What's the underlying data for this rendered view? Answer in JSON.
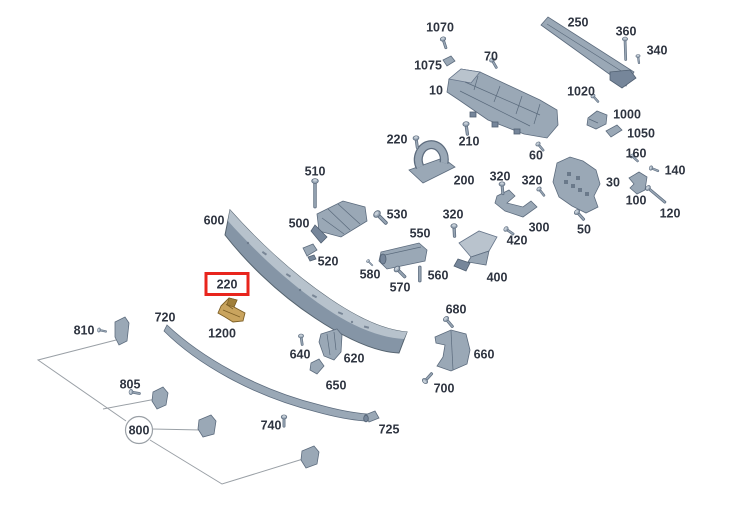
{
  "app": {
    "background": "#ffffff"
  },
  "diagram": {
    "kind": "exploded-parts-diagram",
    "selected_callout": "220",
    "colors": {
      "highlight_box": "#e8251d",
      "highlighted_part": "#c9a45e",
      "part_body": "#9aa8b6",
      "leader_line": "#9aa0a6",
      "label_text": "#2e3440"
    },
    "callouts": [
      {
        "text": "1070",
        "x": 440,
        "y": 27
      },
      {
        "text": "250",
        "x": 578,
        "y": 22
      },
      {
        "text": "360",
        "x": 626,
        "y": 31
      },
      {
        "text": "340",
        "x": 657,
        "y": 50
      },
      {
        "text": "70",
        "x": 491,
        "y": 56
      },
      {
        "text": "1075",
        "x": 428,
        "y": 65
      },
      {
        "text": "10",
        "x": 436,
        "y": 90
      },
      {
        "text": "1020",
        "x": 581,
        "y": 91
      },
      {
        "text": "1000",
        "x": 627,
        "y": 114
      },
      {
        "text": "1050",
        "x": 641,
        "y": 133
      },
      {
        "text": "220",
        "x": 397,
        "y": 139
      },
      {
        "text": "210",
        "x": 469,
        "y": 141
      },
      {
        "text": "60",
        "x": 536,
        "y": 155
      },
      {
        "text": "160",
        "x": 636,
        "y": 153
      },
      {
        "text": "140",
        "x": 675,
        "y": 170
      },
      {
        "text": "510",
        "x": 315,
        "y": 171
      },
      {
        "text": "320",
        "x": 500,
        "y": 176
      },
      {
        "text": "320",
        "x": 532,
        "y": 180
      },
      {
        "text": "30",
        "x": 613,
        "y": 182
      },
      {
        "text": "200",
        "x": 464,
        "y": 180
      },
      {
        "text": "100",
        "x": 636,
        "y": 200
      },
      {
        "text": "120",
        "x": 670,
        "y": 213
      },
      {
        "text": "600",
        "x": 214,
        "y": 220
      },
      {
        "text": "500",
        "x": 299,
        "y": 223
      },
      {
        "text": "530",
        "x": 397,
        "y": 214
      },
      {
        "text": "320",
        "x": 453,
        "y": 214
      },
      {
        "text": "550",
        "x": 420,
        "y": 233
      },
      {
        "text": "300",
        "x": 539,
        "y": 227
      },
      {
        "text": "50",
        "x": 584,
        "y": 229
      },
      {
        "text": "420",
        "x": 517,
        "y": 240
      },
      {
        "text": "520",
        "x": 328,
        "y": 261
      },
      {
        "text": "580",
        "x": 370,
        "y": 274
      },
      {
        "text": "560",
        "x": 438,
        "y": 275
      },
      {
        "text": "400",
        "x": 497,
        "y": 277
      },
      {
        "text": "570",
        "x": 400,
        "y": 287
      },
      {
        "text": "220",
        "x": 227,
        "y": 284,
        "box": "red"
      },
      {
        "text": "680",
        "x": 456,
        "y": 309
      },
      {
        "text": "720",
        "x": 165,
        "y": 317
      },
      {
        "text": "810",
        "x": 84,
        "y": 330
      },
      {
        "text": "1200",
        "x": 222,
        "y": 333
      },
      {
        "text": "640",
        "x": 300,
        "y": 354
      },
      {
        "text": "620",
        "x": 354,
        "y": 358
      },
      {
        "text": "660",
        "x": 484,
        "y": 354
      },
      {
        "text": "650",
        "x": 336,
        "y": 385
      },
      {
        "text": "805",
        "x": 130,
        "y": 384
      },
      {
        "text": "700",
        "x": 444,
        "y": 388
      },
      {
        "text": "740",
        "x": 271,
        "y": 425
      },
      {
        "text": "725",
        "x": 389,
        "y": 429
      },
      {
        "text": "800",
        "x": 139,
        "y": 430,
        "circle": true
      }
    ]
  }
}
